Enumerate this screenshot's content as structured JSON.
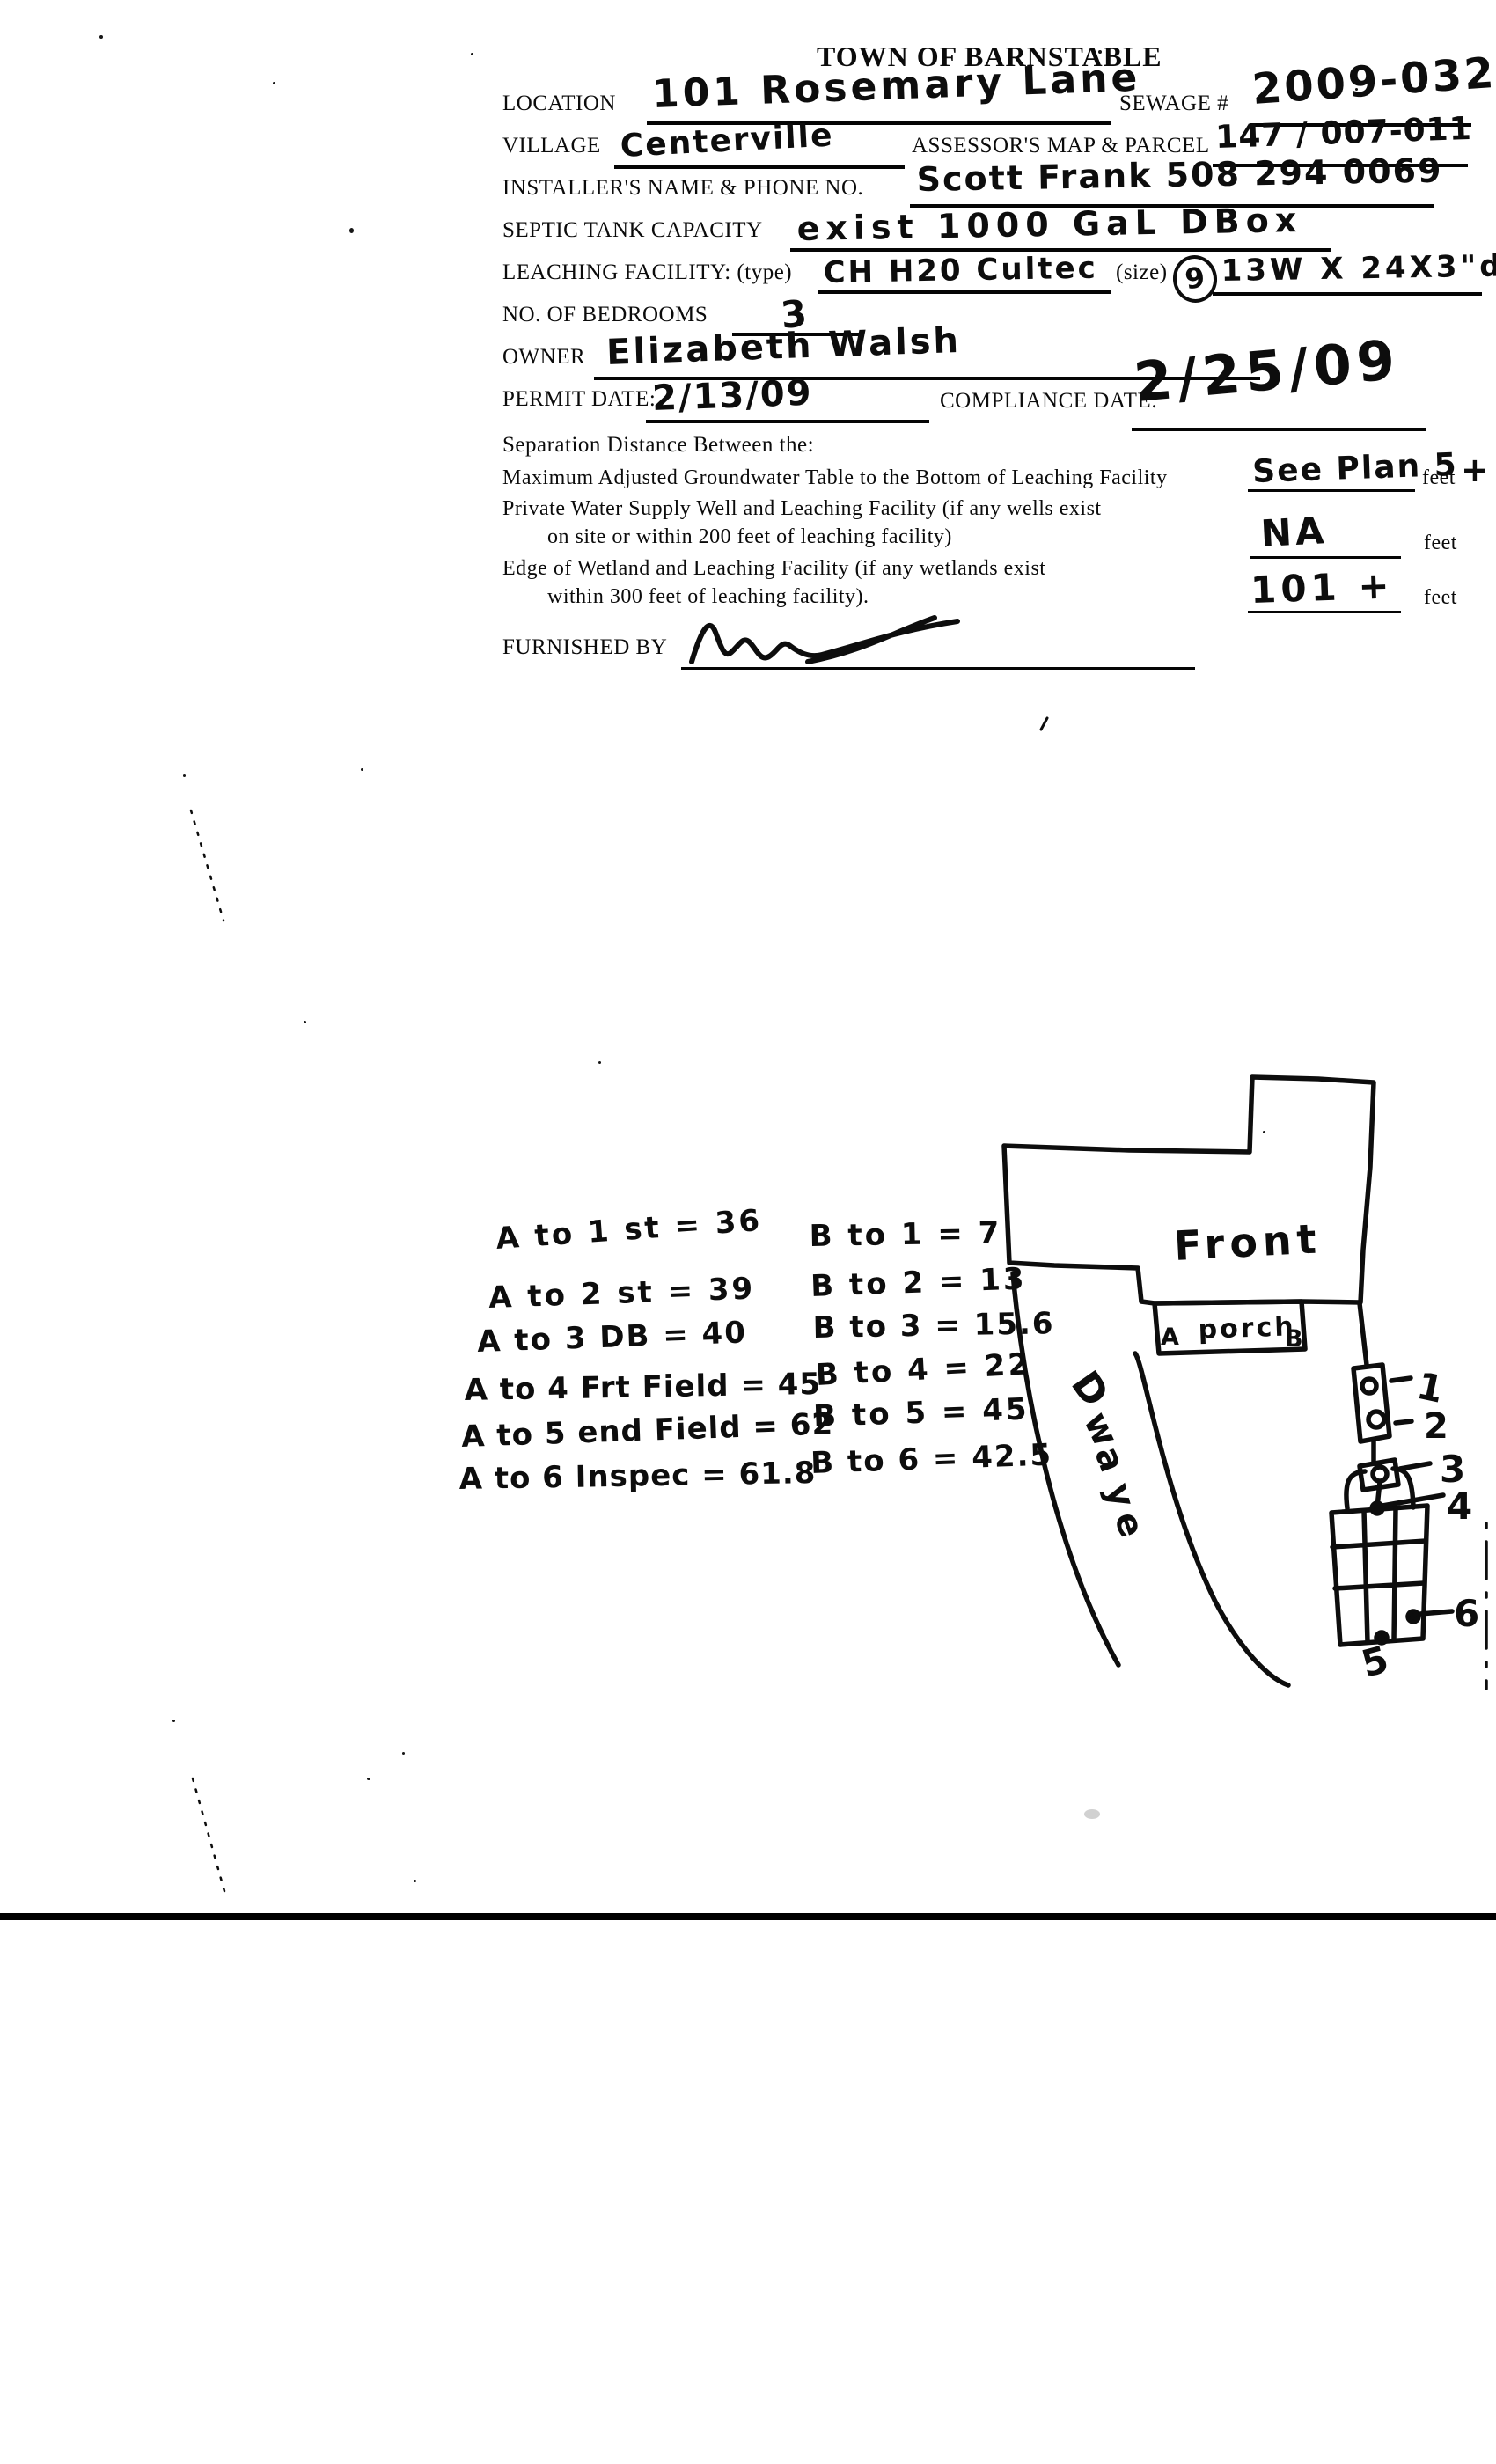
{
  "form": {
    "title": "TOWN OF BARNSTABLE",
    "location": {
      "label": "LOCATION",
      "value": "101 Rosemary Lane"
    },
    "sewage": {
      "label": "SEWAGE #",
      "value": "2009-032"
    },
    "village": {
      "label": "VILLAGE",
      "value": "Centerville"
    },
    "assessors": {
      "label": "ASSESSOR'S MAP & PARCEL",
      "value": "147 / 007-011"
    },
    "installer": {
      "label": "INSTALLER'S NAME & PHONE NO.",
      "value": "Scott Frank 508 294 0069"
    },
    "septic": {
      "label": "SEPTIC TANK CAPACITY",
      "value": "exist 1000 GaL DBox"
    },
    "leaching": {
      "label": "LEACHING FACILITY: (type)",
      "type_value": "CH H20 Cultec",
      "size_label": "(size)",
      "size_circled": "9",
      "size_value": "13W X 24X3\"d"
    },
    "bedrooms": {
      "label": "NO. OF BEDROOMS",
      "value": "3"
    },
    "owner": {
      "label": "OWNER",
      "value": "Elizabeth Walsh"
    },
    "permit": {
      "label": "PERMIT DATE:",
      "value": "2/13/09"
    },
    "compliance": {
      "label": "COMPLIANCE DATE:",
      "value": "2/25/09"
    },
    "separation": {
      "heading": "Separation Distance Between the:",
      "row1": {
        "label": "Maximum Adjusted Groundwater Table to the Bottom of Leaching Facility",
        "value": "See Plan 5",
        "unit": "feet",
        "suffix": "+"
      },
      "row2": {
        "line1": "Private Water Supply Well and Leaching Facility (if any wells exist",
        "line2": "on site or within 200 feet of leaching facility)",
        "value": "NA",
        "unit": "feet"
      },
      "row3": {
        "line1": "Edge of Wetland and Leaching Facility (if any wetlands exist",
        "line2": "within 300 feet of leaching facility).",
        "value": "101 +",
        "unit": "feet"
      }
    },
    "furnished_by": {
      "label": "FURNISHED BY"
    }
  },
  "sketch": {
    "a_measurements": [
      "A to 1 st = 36",
      "A to 2 st = 39",
      "A to 3 DB = 40",
      "A to 4 Frt Field = 45",
      "A to 5 end Field = 62",
      "A to 6 Inspec = 61.8"
    ],
    "b_measurements": [
      "B to 1 = 7",
      "B to 2 = 13",
      "B to 3 = 15.6",
      "B to 4 = 22",
      "B to 5 = 45",
      "B to 6 = 42.5"
    ],
    "house_label": "Front",
    "porch_label": "porch",
    "porch_point_a": "A",
    "porch_point_b": "B",
    "drive_letters": [
      "D",
      "w",
      "a",
      "y",
      "e"
    ],
    "points": [
      "1",
      "2",
      "3",
      "4",
      "5",
      "6"
    ]
  }
}
